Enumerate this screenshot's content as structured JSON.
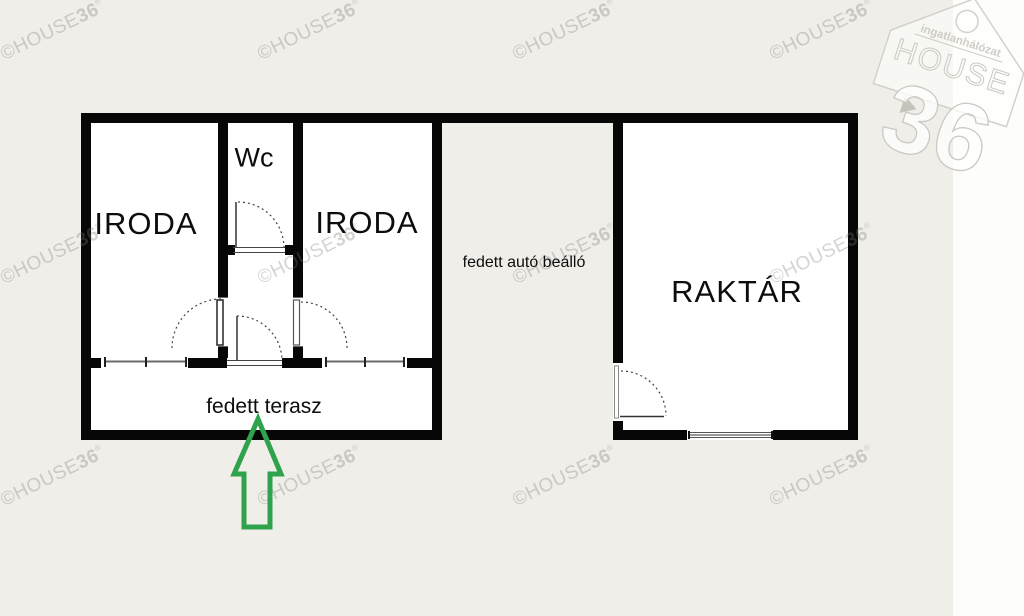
{
  "plan": {
    "rooms": {
      "iroda_left": "IRODA",
      "wc": "Wc",
      "iroda_right": "IRODA",
      "carport": "fedett autó beálló",
      "raktar": "RAKTÁR",
      "terrace": "fedett terasz"
    }
  },
  "watermark": {
    "prefix": "©HOUSE",
    "bold": "36",
    "registered": "®",
    "positions": [
      [
        53,
        31
      ],
      [
        310,
        31
      ],
      [
        565,
        31
      ],
      [
        822,
        31
      ],
      [
        53,
        255
      ],
      [
        310,
        255
      ],
      [
        565,
        255
      ],
      [
        822,
        255
      ],
      [
        53,
        477
      ],
      [
        310,
        477
      ],
      [
        565,
        477
      ],
      [
        822,
        477
      ]
    ]
  },
  "logo": {
    "line1": "ingatlanhálózat",
    "line2": "HOUSE",
    "line3": "36"
  },
  "colors": {
    "background": "#efeee9",
    "paper_strip": "#fdfdfb",
    "wall": "#070707",
    "room_fill": "#ffffff",
    "arrow_green": "#2fa24c",
    "watermark_gray": "#7d7971"
  }
}
